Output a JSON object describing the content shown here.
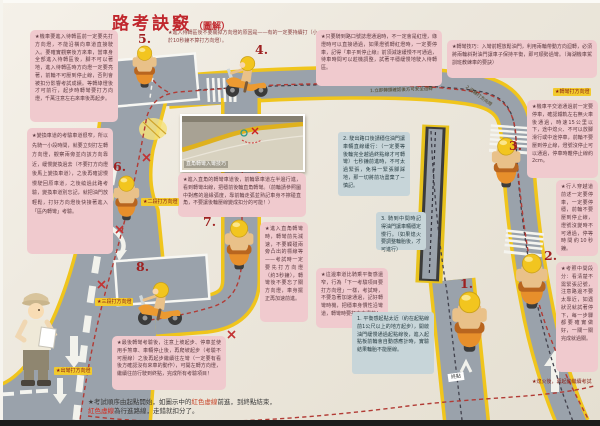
{
  "title": {
    "main": "路考訣竅",
    "sub": "（圖解）"
  },
  "colors": {
    "accent_red": "#c0272d",
    "road_gray": "#9aa2ab",
    "edge_yellow": "#f0c51c",
    "note_pink": "#f0cace",
    "note_blue": "#c7d5d9",
    "route_red": "#b23b35"
  },
  "stations": {
    "s1": "1.",
    "s2": "2.",
    "s3": "3.",
    "s4": "4.",
    "s5": "5.",
    "s6": "6.",
    "s7": "7.",
    "s8": "8."
  },
  "boxes": {
    "left_top": "★機車要進入待轉區前一定要先打方向燈，不能沿橫向車道直接駛入。要確實觀察後方來車，當車身全部進入待轉區後，腳不可以著地，進入待轉區時方向燈一定要亮著，前輪不可壓到停止線，否則會被扣分影響考試成績。等轉綠燈後才可前行，起步時轉彎要打方向燈，千萬注意左右來車後再起步。",
    "left_mid": "★變換車道的考驗車道很窄，所以先騎一小段時間，就要立刻打左轉方向燈，觀察兩旁並向該方向靠近，緩慢變換過去（不要打方向燈後馬上變換車道），之後再確認慢慢駛回原車道，之後繞過此路考驗，變換車道別忘記，就把油門放輕鬆，打好方向燈後快接著進入「區內轉彎」考驗。",
    "top_center": "★進入待轉區後不要關掉方向燈的原因是——有的一定要持續打（小於10秒鐘不算打方向燈）。",
    "top_right": "★只要騎到路口號誌燈通過時，不一定會是紅燈，綠燈時可以直接通過，如果燈號轉紅燈時，一定要停車，記得『車子到停止線』前須減速緩慢不可通過，待車時間可以趁機調整，試著平穩緩慢地駛入待轉區。",
    "right_turn_tips": "★轉彎技巧：入彎前輕放鬆油門，利用兩輪帶動方向迴轉，必須將兩輪斜對油門讓車子保持平衡，即可順勢過彎。（海湖機車駕訓班教練車的要訣）",
    "right_rail": "★機車平交道通過前一定要停車，確認鐵軌左右無火車後通過，時速15公里以下，途中熄火、不可以放腳滑行或中途停車，前輪不要壓到停止線，燈號沒停止可以通過，停車時離停止線約2cm。",
    "right_ped": "★行人穿越道前述一定要停車，一定要停穩，前輪不要壓到停止線，燈號沒變時不可通過，停等時間約10秒鐘。",
    "right_exam": "★考照中間段分：看清楚不需緊張記號，注意路邊不要太靠近，如遇狀況就試著停下，每一步驟都要確實做好，一關一關完成就過關。",
    "photo_caption": "★進入直角的轉彎車道後，前輪靠車道左半邊行進，看到轉彎出線，把穩前後輪直角轉彎。（前輪請參照圖中對應的邊緣弧度，靠前輪走弧並熟記車身不擦碰直角，不要讓後輪壓線變成扣分的可能！）",
    "corner_turn": "★進入直角轉彎時，轉彎前先減速，不要觸碰兩旁凸出的標線等——考試時一定要先打方向燈（約3秒鐘），轉彎後不要忘了關方向燈，車身擺正再加速前進。",
    "lane_change": "★這邊車道比騎乘平衡感還窄，行為「下一考驗項目要打方向燈」一樣，考試時，不要急著加速通過，記好轉彎時機，把穩車身慣性沿彎道，轉彎時要打方向燈的！",
    "final_turn": "★最後轉彎考驗後，注意上坡起步、停車並使用手煞車、車輛停止後，再爬坡起步（考驗不可壓線）之後再起步繼續往左彎（一定要有看後方確認沒有來車的動作），可開左轉方向燈，繼續往前行駛到終點，完成所有考驗項目！",
    "balance_1": "1. 平衡感起點太近（約在起點線前1公尺以上的地方起步），開啟油門緩慢通過起點線後，進入起點板前輪會自動感應計時，實驗結果輪胎不能壓線。",
    "balance_2": "2. 駛出路口後請穩住油門讓車輛直線緩行：（一定要等後輪完全越過終點線才可轉彎）七秒鐘前進時，不可太過緊張，免得一緊張腳踩地，那一切將前功盡棄了－慎記。",
    "balance_3": "3. 騎到中間時記得油門讓車輛穩定慢行。（如果熄火要調整輪胎後，才可進行）"
  },
  "labels": {
    "signal_top_right": "★轉彎打方向燈",
    "signal_turn1": "★二段打方向燈",
    "signal_turn2": "★三段打方向燈",
    "signal_turn3": "★出彎打方向燈",
    "road_step1": "1.立即轉頭確認後方可安全迴轉",
    "road_step2": "2.迴轉打方向燈",
    "photo_title": "直角轉彎入彎技巧",
    "end_tag": "終點",
    "restart_note": "★熄火後，再起動繼續考試",
    "footer_1a": "★考試順序由起點開始，如圖示中的",
    "footer_1b": "紅色虛線",
    "footer_1c": "前進，到終點結束，",
    "footer_2a": "紅色虛線",
    "footer_2b": "為行進路線，走錯就扣分了。"
  }
}
